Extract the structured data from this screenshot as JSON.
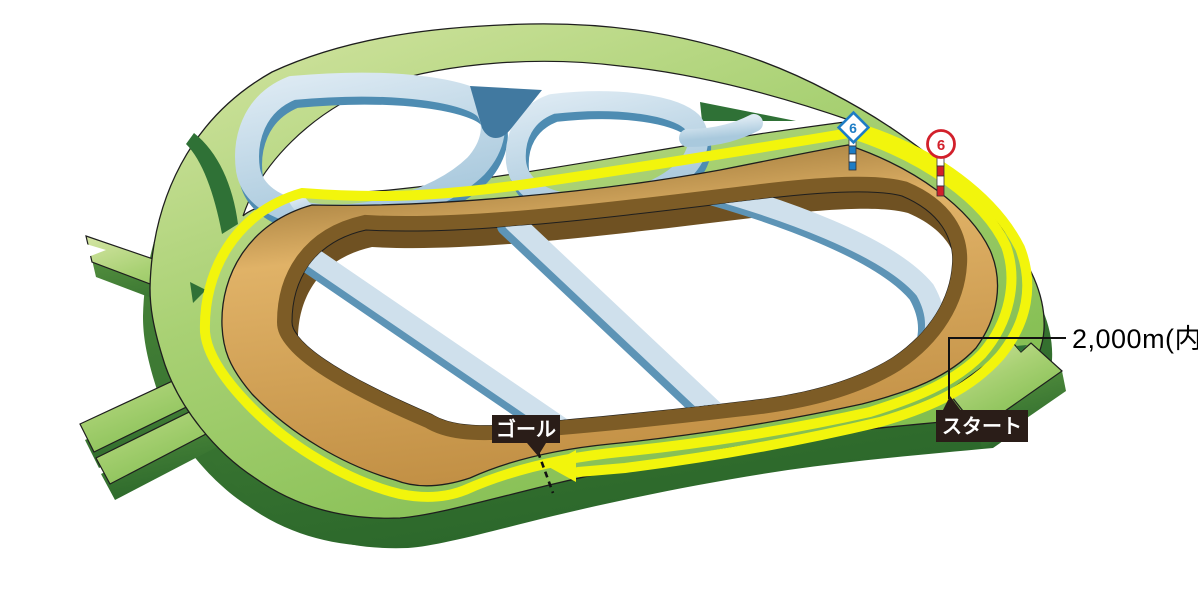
{
  "diagram": {
    "type": "racecourse-3d-course-map",
    "description": "Isometric illustration of a racecourse: green turf courses, yellow highlighted race route with direction arrow, brown dirt track, light-blue steeplechase/training paths in the infield, left-side chute spurs and a bottom-right start chute."
  },
  "labels": {
    "goal": "ゴール",
    "start": "スタート",
    "distance": "2,000m(内)"
  },
  "route": {
    "arrow_direction": "left",
    "finish_line_style": "dashed"
  },
  "markers": {
    "blue": {
      "shape": "diamond",
      "number": "6",
      "color": "#1d7dc6",
      "pole": "blue-white striped"
    },
    "red": {
      "shape": "circle",
      "number": "6",
      "color": "#d2202b",
      "pole": "red-white striped"
    }
  },
  "colors": {
    "turf_light": "#cfe29b",
    "turf_mid": "#9cc96a",
    "turf_dark_side": "#2f6e2e",
    "route_yellow": "#f2f50c",
    "dirt_tan": "#dcb066",
    "dirt_wall_brown": "#6f5122",
    "steeple_blue_light": "#c7dcea",
    "steeple_blue_dark": "#4e8cb2",
    "label_box": "#2a1d18",
    "background": "#ffffff"
  }
}
